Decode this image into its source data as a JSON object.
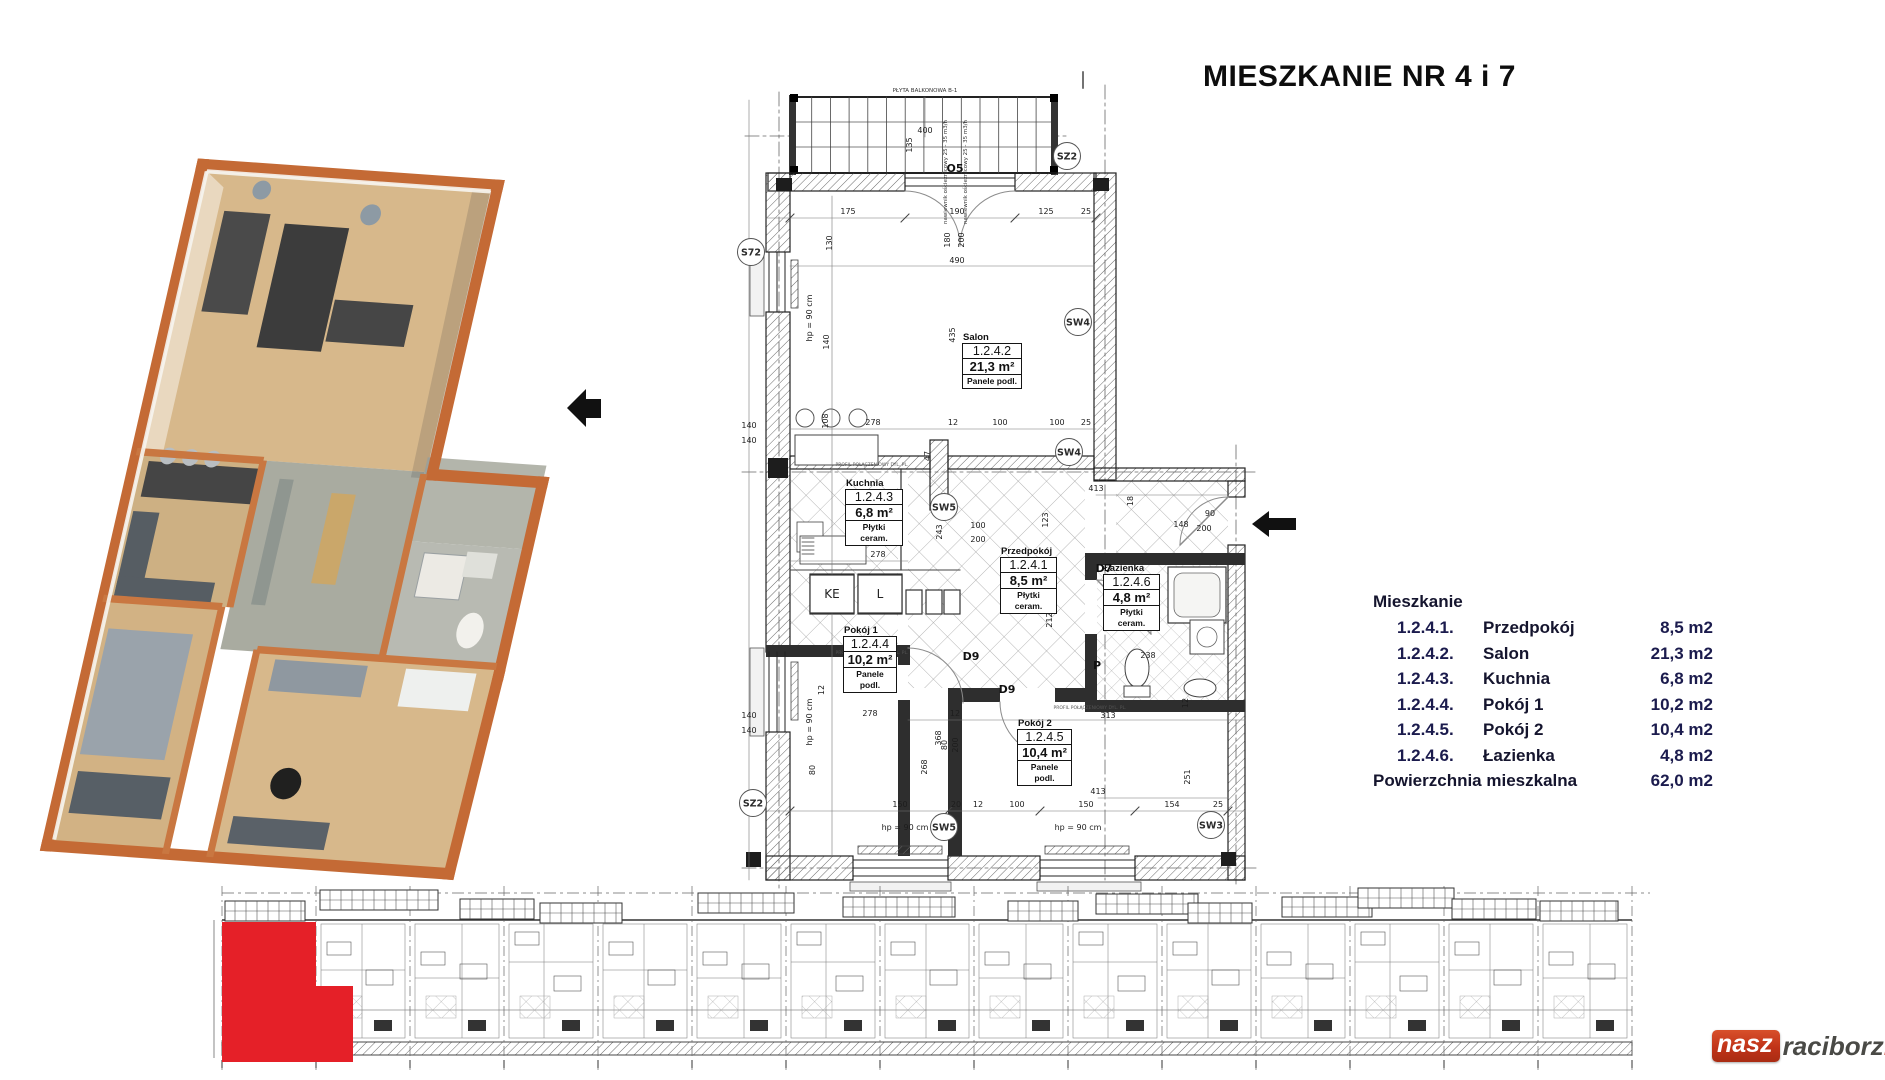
{
  "title": "MIESZKANIE NR 4 i 7",
  "legend": {
    "header": "Mieszkanie",
    "rows": [
      {
        "code": "1.2.4.1.",
        "name": "Przedpokój",
        "area": "8,5 m2"
      },
      {
        "code": "1.2.4.2.",
        "name": "Salon",
        "area": "21,3 m2"
      },
      {
        "code": "1.2.4.3.",
        "name": "Kuchnia",
        "area": "6,8 m2"
      },
      {
        "code": "1.2.4.4.",
        "name": "Pokój 1",
        "area": "10,2 m2"
      },
      {
        "code": "1.2.4.5.",
        "name": "Pokój 2",
        "area": "10,4 m2"
      },
      {
        "code": "1.2.4.6.",
        "name": "Łazienka",
        "area": "4,8 m2"
      }
    ],
    "footer_label": "Powierzchnia mieszkalna",
    "footer_value": "62,0 m2"
  },
  "plan": {
    "rooms": [
      {
        "name": "Salon",
        "code": "1.2.4.2",
        "area": "21,3 m²",
        "floor": "Panele podl."
      },
      {
        "name": "Kuchnia",
        "code": "1.2.4.3",
        "area": "6,8 m²",
        "floor": "Płytki ceram."
      },
      {
        "name": "Przedpokój",
        "code": "1.2.4.1",
        "area": "8,5 m²",
        "floor": "Płytki ceram."
      },
      {
        "name": "Łazienka",
        "code": "1.2.4.6",
        "area": "4,8 m²",
        "floor": "Płytki ceram."
      },
      {
        "name": "Pokój 1",
        "code": "1.2.4.4",
        "area": "10,2 m²",
        "floor": "Panele podl."
      },
      {
        "name": "Pokój 2",
        "code": "1.2.4.5",
        "area": "10,4 m²",
        "floor": "Panele podl."
      }
    ],
    "notes": {
      "balcony_label": "PŁYTA BALKONOWA B-1",
      "vent_note": "nawiewnik ościeżnicowy 25 - 35 m3/h",
      "profile_note": "PROFIL POŁĄCZENIOWY DYL. PL.",
      "hp_note": "hp = 90 cm"
    },
    "markers": [
      {
        "t": "O5",
        "x": 955,
        "y": 172,
        "k": "t"
      },
      {
        "t": "SZ2",
        "x": 1067,
        "y": 156,
        "k": "c"
      },
      {
        "t": "S72",
        "x": 751,
        "y": 252,
        "k": "c"
      },
      {
        "t": "SW4",
        "x": 1078,
        "y": 322,
        "k": "c"
      },
      {
        "t": "SW4",
        "x": 1069,
        "y": 452,
        "k": "c"
      },
      {
        "t": "SW5",
        "x": 944,
        "y": 507,
        "k": "c"
      },
      {
        "t": "D7",
        "x": 1104,
        "y": 572,
        "k": "t"
      },
      {
        "t": "D9",
        "x": 971,
        "y": 660,
        "k": "t"
      },
      {
        "t": "D9",
        "x": 1007,
        "y": 693,
        "k": "t"
      },
      {
        "t": "P",
        "x": 1097,
        "y": 669,
        "k": "t"
      },
      {
        "t": "SZ2",
        "x": 753,
        "y": 803,
        "k": "c"
      },
      {
        "t": "SW5",
        "x": 944,
        "y": 827,
        "k": "c"
      },
      {
        "t": "SW3",
        "x": 1211,
        "y": 825,
        "k": "c"
      },
      {
        "t": "KE",
        "x": 832,
        "y": 594,
        "k": "b"
      },
      {
        "t": "L",
        "x": 880,
        "y": 594,
        "k": "b"
      }
    ],
    "dims": [
      {
        "t": "400",
        "x": 925,
        "y": 133
      },
      {
        "t": "135",
        "x": 912,
        "y": 145,
        "r": 1
      },
      {
        "t": "175",
        "x": 848,
        "y": 214
      },
      {
        "t": "190",
        "x": 957,
        "y": 214
      },
      {
        "t": "125",
        "x": 1046,
        "y": 214
      },
      {
        "t": "25",
        "x": 1086,
        "y": 214
      },
      {
        "t": "180",
        "x": 950,
        "y": 240,
        "r": 1
      },
      {
        "t": "200",
        "x": 964,
        "y": 240,
        "r": 1
      },
      {
        "t": "130",
        "x": 832,
        "y": 243,
        "r": 1
      },
      {
        "t": "490",
        "x": 957,
        "y": 263
      },
      {
        "t": "140",
        "x": 829,
        "y": 342,
        "r": 1
      },
      {
        "t": "435",
        "x": 955,
        "y": 335,
        "r": 1
      },
      {
        "t": "hp = 90 cm",
        "x": 812,
        "y": 318,
        "r": 1
      },
      {
        "t": "108",
        "x": 828,
        "y": 421,
        "r": 1
      },
      {
        "t": "278",
        "x": 873,
        "y": 425
      },
      {
        "t": "12",
        "x": 953,
        "y": 425
      },
      {
        "t": "100",
        "x": 1000,
        "y": 425
      },
      {
        "t": "100",
        "x": 1057,
        "y": 425
      },
      {
        "t": "25",
        "x": 1086,
        "y": 425
      },
      {
        "t": "140",
        "x": 749,
        "y": 428
      },
      {
        "t": "140",
        "x": 749,
        "y": 443
      },
      {
        "t": "47",
        "x": 930,
        "y": 456,
        "r": 1
      },
      {
        "t": "413",
        "x": 1096,
        "y": 491
      },
      {
        "t": "18",
        "x": 1133,
        "y": 501,
        "r": 1
      },
      {
        "t": "90",
        "x": 1210,
        "y": 516
      },
      {
        "t": "148",
        "x": 1181,
        "y": 527
      },
      {
        "t": "200",
        "x": 1204,
        "y": 531
      },
      {
        "t": "100",
        "x": 978,
        "y": 528
      },
      {
        "t": "200",
        "x": 978,
        "y": 542
      },
      {
        "t": "243",
        "x": 942,
        "y": 532,
        "r": 1
      },
      {
        "t": "123",
        "x": 1048,
        "y": 520,
        "r": 1
      },
      {
        "t": "278",
        "x": 878,
        "y": 557
      },
      {
        "t": "238",
        "x": 1148,
        "y": 658
      },
      {
        "t": "212",
        "x": 1052,
        "y": 620,
        "r": 1
      },
      {
        "t": "12",
        "x": 824,
        "y": 690,
        "r": 1
      },
      {
        "t": "80",
        "x": 815,
        "y": 770,
        "r": 1
      },
      {
        "t": "80",
        "x": 947,
        "y": 745,
        "r": 1
      },
      {
        "t": "200",
        "x": 958,
        "y": 745,
        "r": 1
      },
      {
        "t": "278",
        "x": 870,
        "y": 716
      },
      {
        "t": "12",
        "x": 955,
        "y": 716
      },
      {
        "t": "313",
        "x": 1108,
        "y": 718
      },
      {
        "t": "368",
        "x": 941,
        "y": 738,
        "r": 1
      },
      {
        "t": "268",
        "x": 927,
        "y": 767,
        "r": 1
      },
      {
        "t": "12",
        "x": 1188,
        "y": 703,
        "r": 1
      },
      {
        "t": "251",
        "x": 1190,
        "y": 777,
        "r": 1
      },
      {
        "t": "140",
        "x": 749,
        "y": 718
      },
      {
        "t": "140",
        "x": 749,
        "y": 733
      },
      {
        "t": "hp = 90 cm",
        "x": 812,
        "y": 722,
        "r": 1
      },
      {
        "t": "413",
        "x": 1098,
        "y": 794
      },
      {
        "t": "150",
        "x": 900,
        "y": 807
      },
      {
        "t": "20",
        "x": 956,
        "y": 807
      },
      {
        "t": "12",
        "x": 978,
        "y": 807
      },
      {
        "t": "100",
        "x": 1017,
        "y": 807
      },
      {
        "t": "150",
        "x": 1086,
        "y": 807
      },
      {
        "t": "154",
        "x": 1172,
        "y": 807
      },
      {
        "t": "25",
        "x": 1218,
        "y": 807
      },
      {
        "t": "hp = 90 cm",
        "x": 905,
        "y": 830
      },
      {
        "t": "hp = 90 cm",
        "x": 1078,
        "y": 830
      }
    ]
  },
  "building_strip": {
    "highlight_color": "#e52028"
  },
  "watermark": {
    "part1": "nasz",
    "part2": "raciborz",
    "part3": "pl"
  },
  "colors": {
    "accent_red": "#e52028",
    "wall_orange": "#c46a35",
    "floor_wood": "#d7b88b",
    "line_dark": "#1d1d1d"
  }
}
